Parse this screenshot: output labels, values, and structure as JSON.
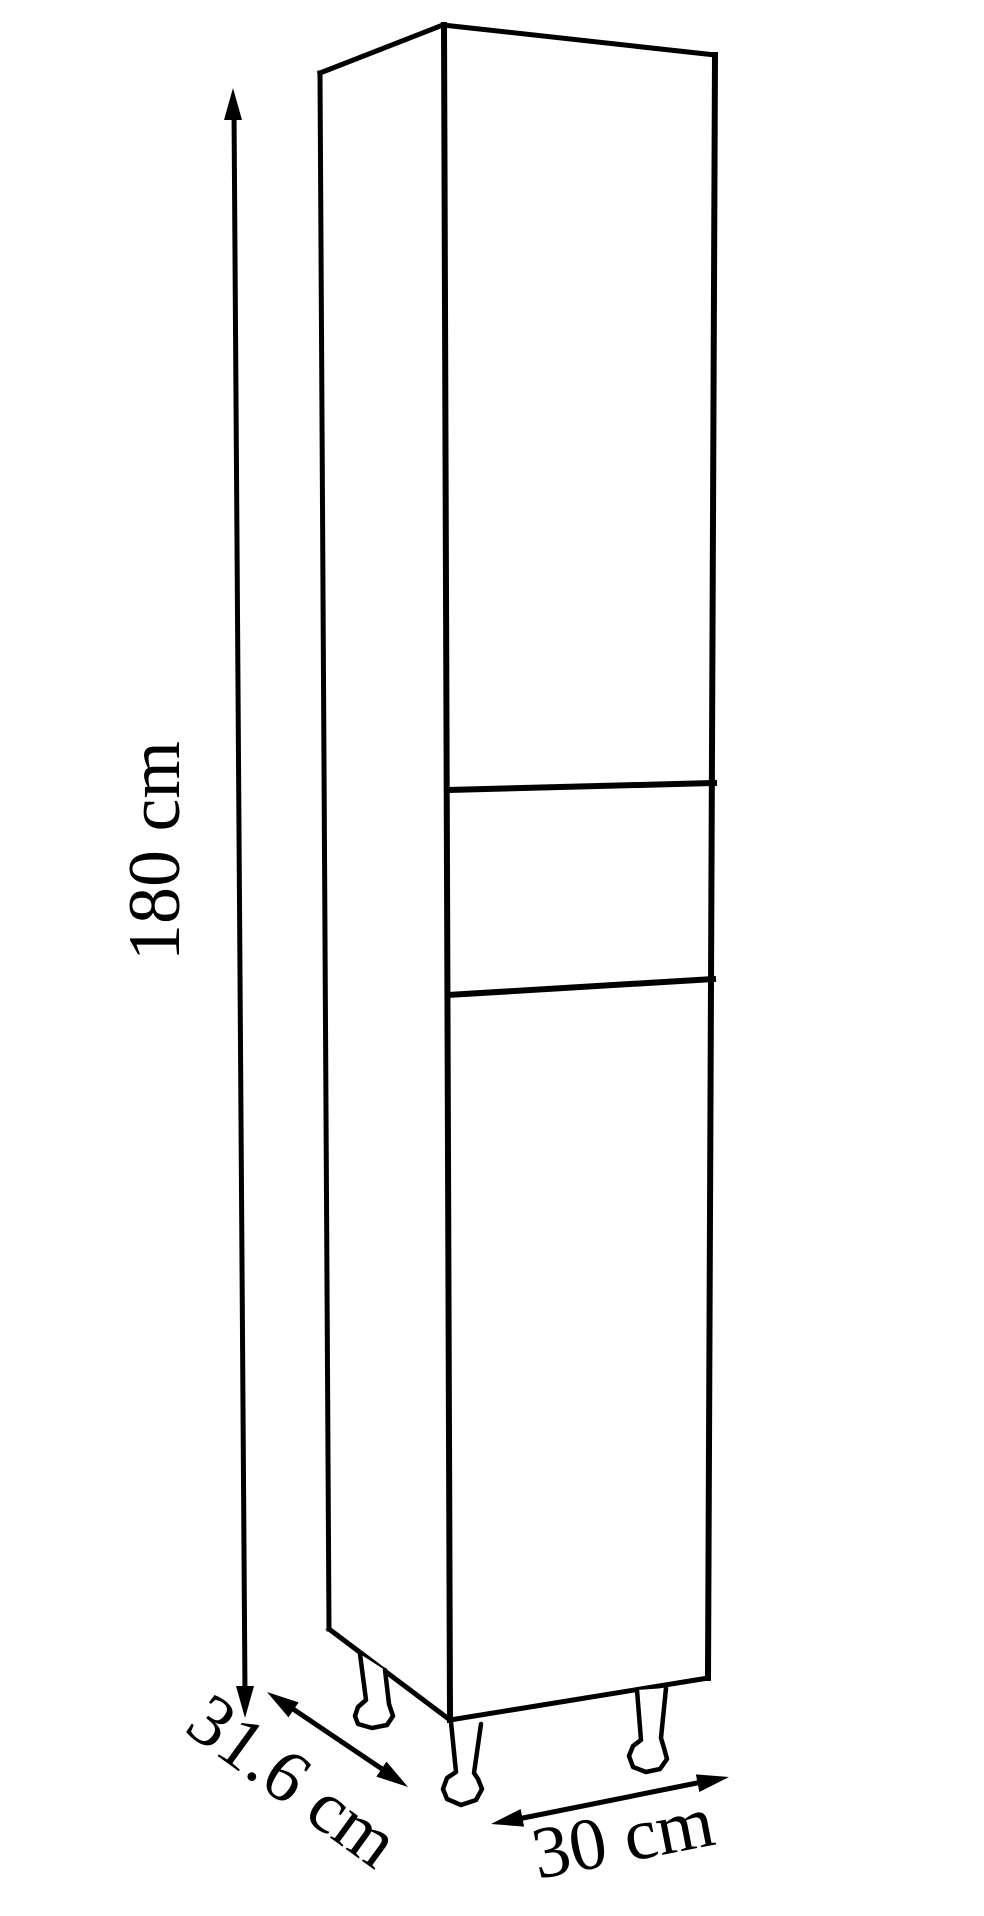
{
  "diagram": {
    "background_color": "#ffffff",
    "line_color": "#000000",
    "labels": {
      "height": {
        "text": "180 cm",
        "value": 180,
        "unit": "cm"
      },
      "depth": {
        "text": "31.6 cm",
        "value": 31.6,
        "unit": "cm"
      },
      "width": {
        "text": "30 cm",
        "value": 30,
        "unit": "cm"
      }
    }
  }
}
